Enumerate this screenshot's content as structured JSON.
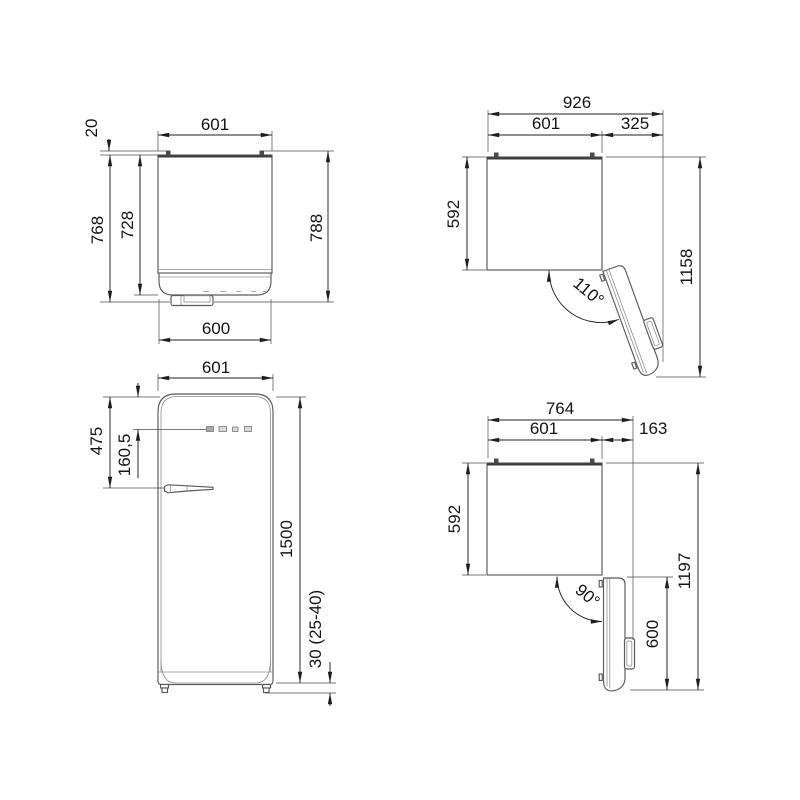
{
  "page": {
    "background": "#ffffff",
    "drawing_line_color": "#5a5a5a",
    "dimension_line_color": "#1f1f1f",
    "text_color": "#141414",
    "description": "Refrigerator installation dimension drawing, four orthographic views, dimensions in mm"
  },
  "views": {
    "top_closed": {
      "label": "Top view, door closed",
      "dims": {
        "hinge": "20",
        "width": "601",
        "depth_body": "728",
        "depth": "768",
        "depth_total": "788",
        "door_width": "600"
      }
    },
    "top_open_110": {
      "label": "Top view, door open 110°",
      "dims": {
        "overall_width": "926",
        "width": "601",
        "door_projection": "325",
        "depth_body": "592",
        "overall_depth": "1158",
        "angle": "110°"
      }
    },
    "front": {
      "label": "Front view",
      "dims": {
        "width": "601",
        "handle_from_top": "475",
        "controls_offset": "160,5",
        "height": "1500",
        "feet_height": "30 (25-40)"
      }
    },
    "top_open_90": {
      "label": "Top view, door open 90°",
      "dims": {
        "overall_width": "764",
        "width": "601",
        "door_projection": "163",
        "depth_body": "592",
        "overall_depth": "1197",
        "door_width": "600",
        "angle": "90°"
      }
    }
  }
}
